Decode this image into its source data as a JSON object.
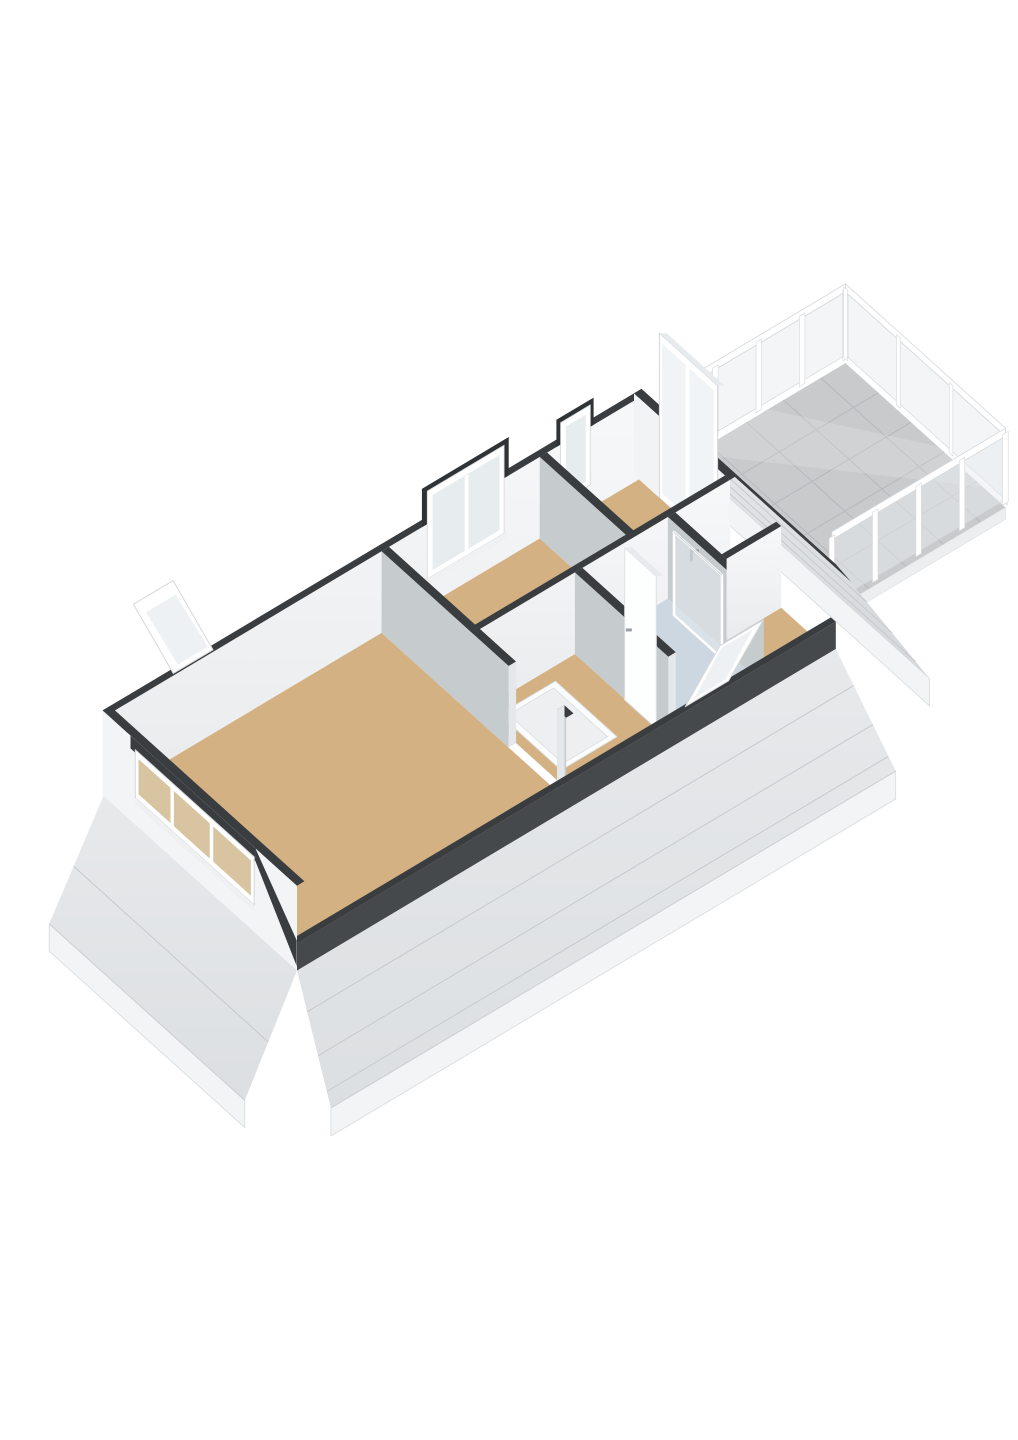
{
  "meta": {
    "kind": "3d-floorplan-render",
    "background": "#ffffff"
  },
  "colors": {
    "background": "#ffffff",
    "floor_wood": "#d3b183",
    "floor_bathroom": "#ccd7e1",
    "floor_toilet": "#eef0f1",
    "balcony_tile": "#c8cacc",
    "balcony_tile_line": "#b6b9bb",
    "wall_cap": "#393d40",
    "wall_cap_dark": "#2f3335",
    "wall_white": "#f4f6f7",
    "wall_white_shade": "#eceef0",
    "wall_gray": "#c6cbce",
    "wall_end": "#e5e8ea",
    "roof_light": "#e8eaec",
    "roof_mid": "#d6d9db",
    "roof_seam": "#c7cacc",
    "fascia": "#f3f4f5",
    "fascia_line": "#d8dbdd",
    "glass": "#e7ecef",
    "glass_tinted": "#d9c4a1",
    "frame": "#ffffff",
    "frame_line": "#d5d8da",
    "metal": "#9aa0a4",
    "hatch_inner": "#edeff1",
    "knee_dark": "#45494c",
    "door_white": "#fdfefe"
  },
  "rooms": [
    {
      "name": "living-room",
      "floor": "wood"
    },
    {
      "name": "bedroom",
      "floor": "wood"
    },
    {
      "name": "landing",
      "floor": "wood"
    },
    {
      "name": "bathroom",
      "floor": "bathroom-blue"
    },
    {
      "name": "toilet",
      "floor": "light"
    },
    {
      "name": "bedroom-2",
      "floor": "wood"
    },
    {
      "name": "balcony",
      "floor": "tile"
    }
  ],
  "features": [
    "glass-balcony-railing",
    "stair-opening-hatch",
    "dormer-window-band",
    "dormer-window-bedroom",
    "balcony-door-glazed",
    "leaning-roof-window-back",
    "leaning-roof-window-bathroom",
    "shower-screen",
    "wall-faucet",
    "mansard-roof-skirt"
  ]
}
